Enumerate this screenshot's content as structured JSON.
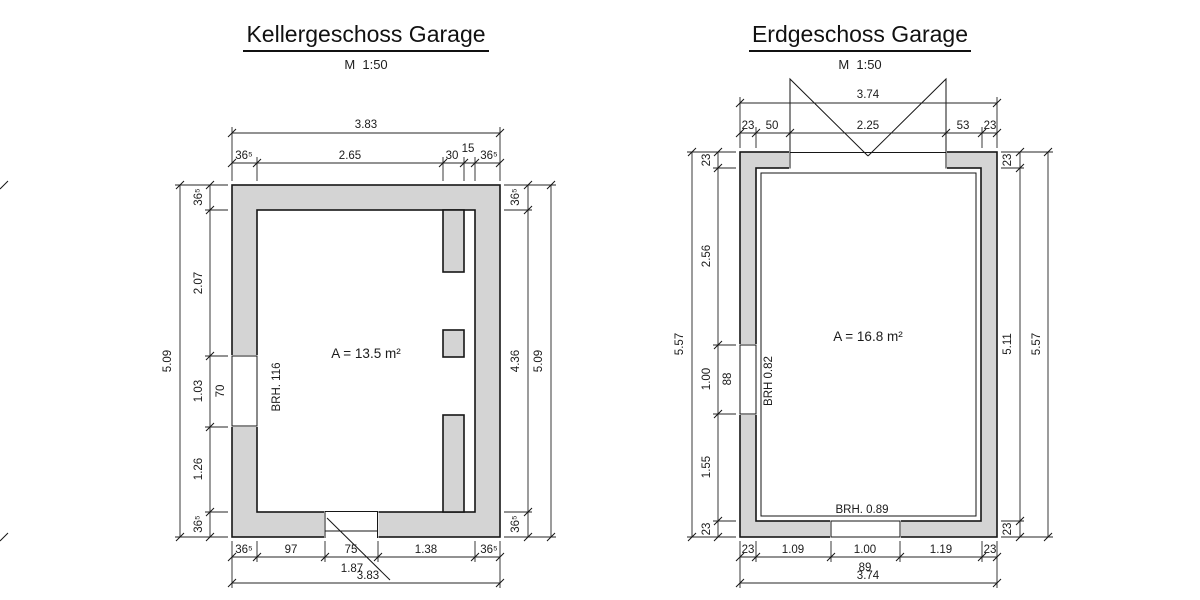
{
  "colors": {
    "wall_fill": "#d4d4d4",
    "line": "#161616",
    "background": "#ffffff"
  },
  "kg": {
    "title": "Kellergeschoss Garage",
    "scale": "M  1:50",
    "area": "A = 13.5 m²",
    "window_brh": "BRH. 116",
    "dim": {
      "top_total": "3.83",
      "top_chain": [
        "36⁵",
        "2.65",
        "30",
        "15",
        "36⁵"
      ],
      "left_total": "5.09",
      "left_chain": [
        "36⁵",
        "2.07",
        "1.03",
        "1.26",
        "36⁵"
      ],
      "left_window_width": "70",
      "right_total": "5.09",
      "right_chain": [
        "36⁵",
        "4.36",
        "36⁵"
      ],
      "bottom_total": "3.83",
      "bottom_chain": [
        "36⁵",
        "97",
        "75",
        "1.38",
        "36⁵"
      ],
      "door_leader": "1.87"
    }
  },
  "eg": {
    "title": "Erdgeschoss Garage",
    "scale": "M  1:50",
    "area": "A = 16.8 m²",
    "left_window_brh": "BRH 0.82",
    "bottom_window_brh": "BRH. 0.89",
    "dim": {
      "top_total": "3.74",
      "top_chain": [
        "23",
        "50",
        "2.25",
        "53",
        "23"
      ],
      "left_total": "5.57",
      "left_chain": [
        "23",
        "2.56",
        "1.00",
        "1.55",
        "23"
      ],
      "left_window_width": "88",
      "right_total": "5.57",
      "right_chain": [
        "23",
        "5.11",
        "23"
      ],
      "bottom_total": "3.74",
      "bottom_chain": [
        "23",
        "1.09",
        "1.00",
        "1.19",
        "23"
      ],
      "bottom_window_width": "89"
    }
  }
}
